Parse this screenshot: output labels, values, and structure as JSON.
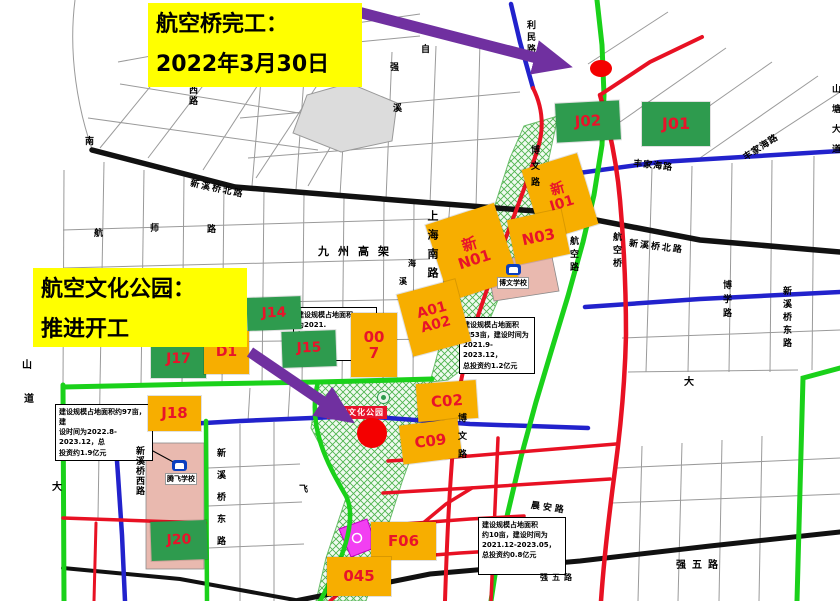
{
  "callouts": {
    "bridge": {
      "line1": "航空桥完工：",
      "line2": "2022年3月30日"
    },
    "park": {
      "line1": "航空文化公园：",
      "line2": "推进开工"
    }
  },
  "park_label": "航空文化公园",
  "schools": {
    "bowen": "博文学校",
    "tengfei": "腾飞学校"
  },
  "parcels": [
    {
      "id": "j02",
      "color": "green",
      "lines": [
        "J02"
      ],
      "x": 556,
      "y": 102,
      "w": 64,
      "h": 39,
      "rot": -3,
      "fs": 15
    },
    {
      "id": "j01",
      "color": "green",
      "lines": [
        "J01"
      ],
      "x": 642,
      "y": 102,
      "w": 68,
      "h": 44,
      "rot": 0,
      "fs": 16
    },
    {
      "id": "xin-j01",
      "color": "orange",
      "lines": [
        "新",
        "J01"
      ],
      "x": 531,
      "y": 160,
      "w": 58,
      "h": 74,
      "rot": -17,
      "fs": 14
    },
    {
      "id": "xin-n01",
      "color": "orange",
      "lines": [
        "新",
        "N01"
      ],
      "x": 436,
      "y": 212,
      "w": 72,
      "h": 80,
      "rot": -18,
      "fs": 15
    },
    {
      "id": "n03",
      "color": "orange",
      "lines": [
        "N03"
      ],
      "x": 511,
      "y": 214,
      "w": 55,
      "h": 46,
      "rot": -12,
      "fs": 15
    },
    {
      "id": "a01-a02",
      "color": "orange",
      "lines": [
        "A01",
        "A02"
      ],
      "x": 404,
      "y": 286,
      "w": 60,
      "h": 64,
      "rot": -15,
      "fs": 14
    },
    {
      "id": "007",
      "color": "orange",
      "lines": [
        "00",
        "7"
      ],
      "x": 351,
      "y": 313,
      "w": 46,
      "h": 64,
      "rot": 0,
      "fs": 15
    },
    {
      "id": "c02",
      "color": "orange",
      "lines": [
        "C02"
      ],
      "x": 417,
      "y": 382,
      "w": 60,
      "h": 38,
      "rot": -4,
      "fs": 15
    },
    {
      "id": "c09",
      "color": "orange",
      "lines": [
        "C09"
      ],
      "x": 401,
      "y": 422,
      "w": 59,
      "h": 39,
      "rot": -7,
      "fs": 15
    },
    {
      "id": "j14",
      "color": "green",
      "lines": [
        "J14"
      ],
      "x": 247,
      "y": 297,
      "w": 54,
      "h": 33,
      "rot": -2,
      "fs": 14
    },
    {
      "id": "j15",
      "color": "green",
      "lines": [
        "J15"
      ],
      "x": 282,
      "y": 331,
      "w": 54,
      "h": 36,
      "rot": -2,
      "fs": 14
    },
    {
      "id": "j17",
      "color": "green",
      "lines": [
        "J17"
      ],
      "x": 151,
      "y": 341,
      "w": 55,
      "h": 37,
      "rot": 0,
      "fs": 14
    },
    {
      "id": "d1",
      "color": "orange",
      "lines": [
        "D1"
      ],
      "x": 204,
      "y": 331,
      "w": 45,
      "h": 43,
      "rot": 0,
      "fs": 14
    },
    {
      "id": "j18",
      "color": "orange",
      "lines": [
        "J18"
      ],
      "x": 148,
      "y": 396,
      "w": 53,
      "h": 35,
      "rot": 0,
      "fs": 15
    },
    {
      "id": "j20",
      "color": "green",
      "lines": [
        "J20"
      ],
      "x": 151,
      "y": 521,
      "w": 56,
      "h": 39,
      "rot": -2,
      "fs": 14
    },
    {
      "id": "f06",
      "color": "orange",
      "lines": [
        "F06"
      ],
      "x": 371,
      "y": 522,
      "w": 65,
      "h": 38,
      "rot": 0,
      "fs": 15
    },
    {
      "id": "045",
      "color": "orange",
      "lines": [
        "045"
      ],
      "x": 327,
      "y": 557,
      "w": 64,
      "h": 39,
      "rot": 0,
      "fs": 15
    }
  ],
  "notes": [
    {
      "id": "note-a",
      "x": 293,
      "y": 307,
      "w": 76,
      "h": 48,
      "lines": [
        "建设规模占地面积",
        "为2021.",
        "亿元"
      ]
    },
    {
      "id": "note-b",
      "x": 459,
      "y": 317,
      "w": 68,
      "h": 50,
      "lines": [
        "建设规模占地面积",
        "约53亩，建设时间为",
        "2021.9-2023.12，",
        "总投资约1.2亿元"
      ]
    },
    {
      "id": "note-c",
      "x": 55,
      "y": 404,
      "w": 90,
      "h": 42,
      "lines": [
        "建设规模占地面积约97亩，建",
        "设时间为2022.8-2023.12，总",
        "投资约1.9亿元"
      ]
    },
    {
      "id": "note-d",
      "x": 478,
      "y": 517,
      "w": 80,
      "h": 52,
      "lines": [
        "建设规模占地面积",
        "约10亩，建设时间为",
        "2021.12-2023.05，",
        "总投资约0.8亿元"
      ]
    }
  ],
  "road_labels": [
    {
      "t": "利民路",
      "x": 524,
      "y": 20,
      "mode": "v",
      "size": 9,
      "ls": 3
    },
    {
      "t": "自",
      "x": 421,
      "y": 42,
      "mode": "h",
      "size": 9
    },
    {
      "t": "强",
      "x": 390,
      "y": 60,
      "mode": "h",
      "size": 9
    },
    {
      "t": "溪",
      "x": 393,
      "y": 101,
      "mode": "h",
      "size": 9
    },
    {
      "t": "西路",
      "x": 186,
      "y": 85,
      "mode": "v",
      "size": 9,
      "ls": 2
    },
    {
      "t": "南",
      "x": 85,
      "y": 134,
      "mode": "h",
      "size": 9
    },
    {
      "t": "航",
      "x": 94,
      "y": 226,
      "mode": "h",
      "size": 9
    },
    {
      "t": "师",
      "x": 150,
      "y": 221,
      "mode": "h",
      "size": 9
    },
    {
      "t": "路",
      "x": 207,
      "y": 222,
      "mode": "h",
      "size": 9
    },
    {
      "t": "新溪桥北路",
      "x": 192,
      "y": 176,
      "mode": "h",
      "rot": 12,
      "size": 9,
      "ls": 2
    },
    {
      "t": "新溪桥北路",
      "x": 630,
      "y": 236,
      "mode": "h",
      "rot": 7,
      "size": 9,
      "ls": 2
    },
    {
      "t": "丰家海路",
      "x": 634,
      "y": 156,
      "mode": "h",
      "rot": 6,
      "size": 9,
      "ls": 1
    },
    {
      "t": "丰家海路",
      "x": 740,
      "y": 152,
      "mode": "h",
      "rot": -33,
      "size": 9,
      "ls": 1
    },
    {
      "t": "九州高架",
      "x": 318,
      "y": 243,
      "mode": "h",
      "size": 11,
      "ls": 9
    },
    {
      "t": "上海南路",
      "x": 424,
      "y": 210,
      "mode": "v",
      "size": 11,
      "ls": 8
    },
    {
      "t": "博文路",
      "x": 528,
      "y": 145,
      "mode": "v",
      "size": 9,
      "ls": 7
    },
    {
      "t": "博文路",
      "x": 455,
      "y": 413,
      "mode": "v",
      "size": 9,
      "ls": 9
    },
    {
      "t": "航空路",
      "x": 567,
      "y": 236,
      "mode": "v",
      "size": 9,
      "ls": 4
    },
    {
      "t": "航空桥",
      "x": 610,
      "y": 232,
      "mode": "v",
      "size": 9,
      "ls": 4
    },
    {
      "t": "博学路",
      "x": 720,
      "y": 280,
      "mode": "v",
      "size": 9,
      "ls": 5
    },
    {
      "t": "山塘大道",
      "x": 829,
      "y": 84,
      "mode": "v",
      "size": 9,
      "ls": 11
    },
    {
      "t": "大",
      "x": 684,
      "y": 373,
      "mode": "h",
      "size": 10
    },
    {
      "t": "新溪桥西路",
      "x": 133,
      "y": 446,
      "mode": "v",
      "size": 9,
      "ls": 1
    },
    {
      "t": "新溪桥东路",
      "x": 214,
      "y": 448,
      "mode": "v",
      "size": 9,
      "ls": 13
    },
    {
      "t": "新溪桥东路",
      "x": 780,
      "y": 286,
      "mode": "v",
      "size": 9,
      "ls": 4
    },
    {
      "t": "晨安路",
      "x": 532,
      "y": 498,
      "mode": "h",
      "rot": 8,
      "size": 9,
      "ls": 3
    },
    {
      "t": "强五路",
      "x": 676,
      "y": 556,
      "mode": "h",
      "size": 10,
      "ls": 6
    },
    {
      "t": "强五路",
      "x": 540,
      "y": 572,
      "mode": "h",
      "size": 8,
      "ls": 4
    },
    {
      "t": "山",
      "x": 22,
      "y": 356,
      "mode": "h",
      "size": 10
    },
    {
      "t": "道",
      "x": 24,
      "y": 390,
      "mode": "h",
      "size": 10
    },
    {
      "t": "大",
      "x": 52,
      "y": 478,
      "mode": "h",
      "size": 10
    },
    {
      "t": "飞",
      "x": 299,
      "y": 482,
      "mode": "h",
      "size": 9
    },
    {
      "t": "海",
      "x": 408,
      "y": 258,
      "mode": "h",
      "size": 8
    },
    {
      "t": "溪",
      "x": 399,
      "y": 276,
      "mode": "h",
      "size": 8
    }
  ],
  "colors": {
    "callout_bg": "#FFFF00",
    "arrow": "#7030A0",
    "marker": "#F40000",
    "parcel_green": "#2E9B4E",
    "parcel_orange": "#F7AE00",
    "parcel_text": "#E8132A",
    "road_green": "#1AD11A",
    "road_red": "#E81123",
    "road_blue": "#2222CC",
    "road_black": "#111111",
    "hatch_green": "#4FB44F",
    "school_pink": "#E9B9AF",
    "kindergarten_magenta": "#F23FF2"
  }
}
